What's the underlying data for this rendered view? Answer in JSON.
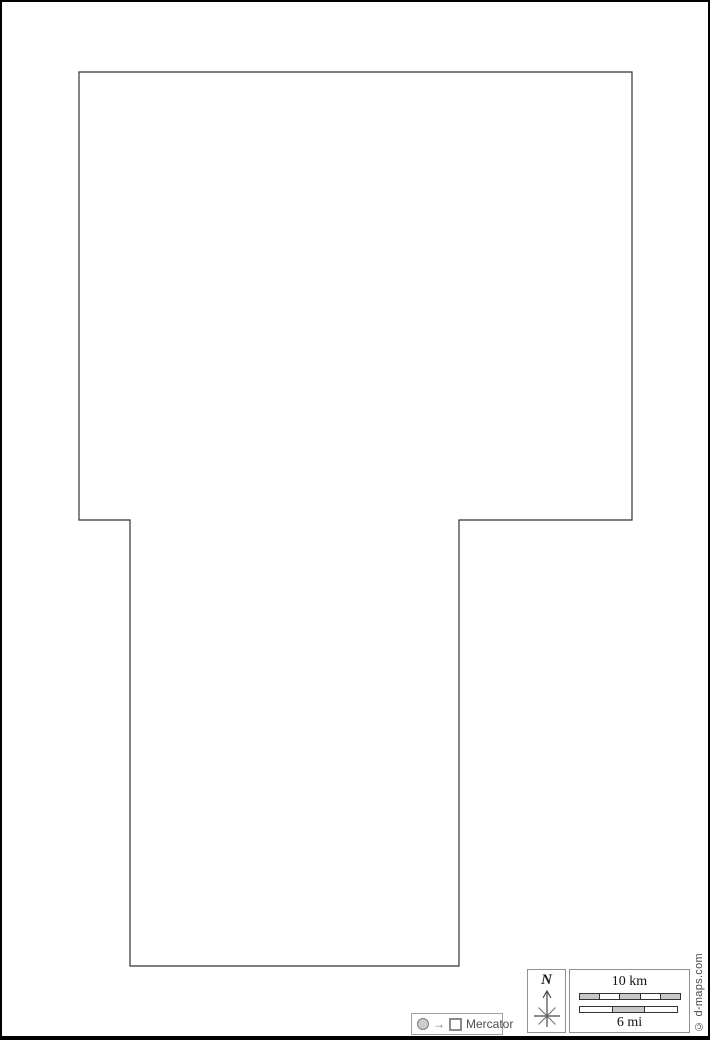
{
  "map": {
    "outline_points": "77,70 630,70 630,518 457,518 457,964 128,964 128,518 77,518",
    "outline_color": "#333333"
  },
  "projection": {
    "label": "Mercator",
    "arrow_glyph": "→"
  },
  "compass": {
    "label": "N"
  },
  "scale": {
    "km_label": "10 km",
    "mi_label": "6 mi",
    "km_segments": [
      "#c8c8c8",
      "#ffffff",
      "#c8c8c8",
      "#ffffff",
      "#c8c8c8"
    ],
    "mi_segments": [
      "#ffffff",
      "#c8c8c8",
      "#ffffff"
    ]
  },
  "copyright": "© d-maps.com",
  "colors": {
    "page_border": "#000000",
    "box_border": "#909090",
    "label_gray": "#4a4a4a"
  }
}
